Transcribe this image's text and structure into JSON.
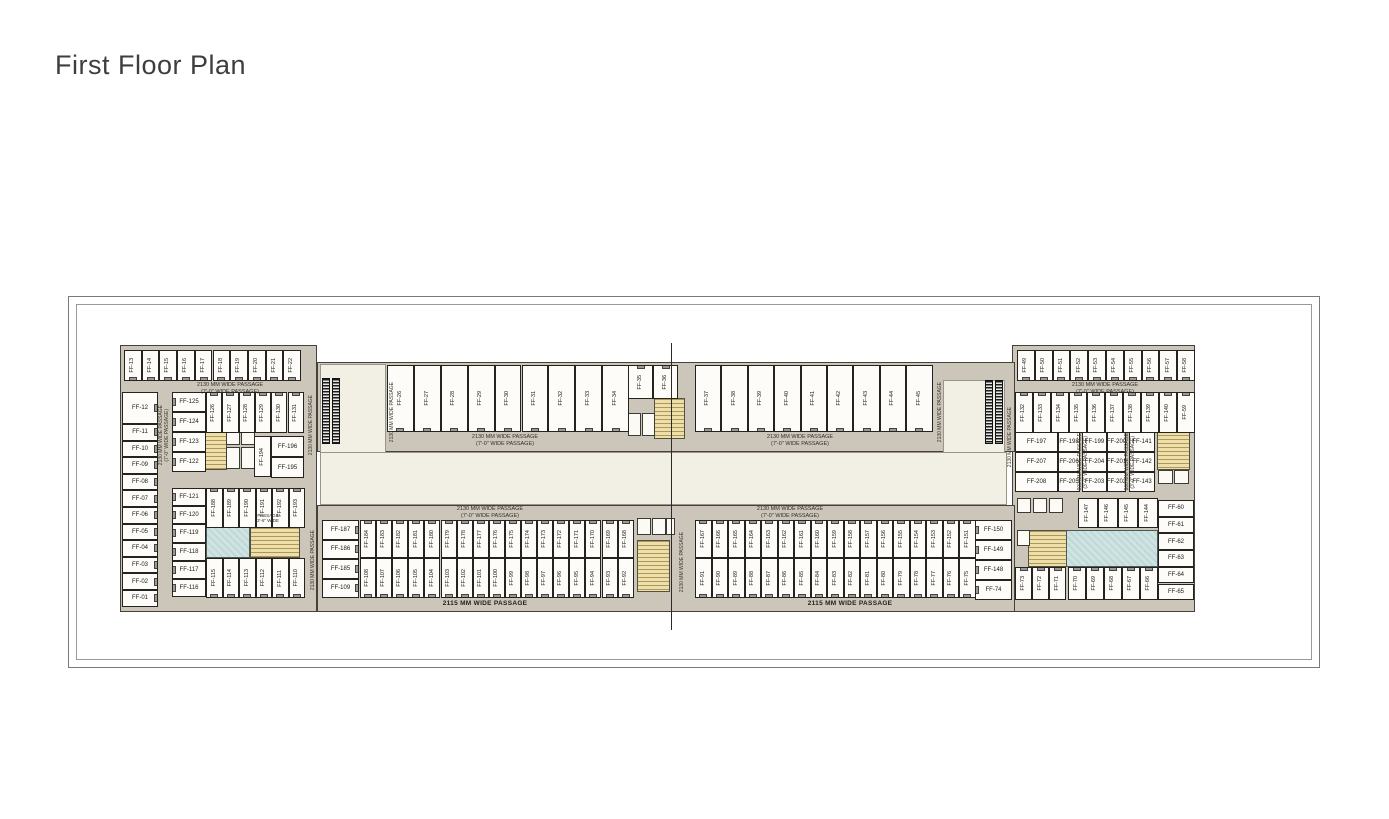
{
  "title": "First Floor Plan",
  "colors": {
    "plan_background": "#cbc5ba",
    "atrium": "#f2efe5",
    "unit_fill": "#fdfcf8",
    "wall": "#26231f",
    "stair": "#eedfa8",
    "toilet": "#cfe4e2",
    "escalator": "#1c1c1c"
  },
  "plan": {
    "base": [
      {
        "cls": "wing",
        "x": 120,
        "y": 345,
        "w": 197,
        "h": 267
      },
      {
        "cls": "wing",
        "x": 1012,
        "y": 345,
        "w": 183,
        "h": 267
      },
      {
        "cls": "band",
        "x": 317,
        "y": 362,
        "w": 698,
        "h": 90
      },
      {
        "cls": "band",
        "x": 317,
        "y": 505,
        "w": 698,
        "h": 107
      },
      {
        "cls": "atrium",
        "x": 320,
        "y": 364,
        "w": 66,
        "h": 141
      },
      {
        "cls": "atrium",
        "x": 943,
        "y": 380,
        "w": 62,
        "h": 125
      },
      {
        "cls": "atrium",
        "x": 320,
        "y": 452,
        "w": 687,
        "h": 53
      }
    ],
    "areas": [
      {
        "type": "stair",
        "x": 205,
        "y": 423,
        "w": 22,
        "h": 47
      },
      {
        "type": "stair",
        "x": 250,
        "y": 527,
        "w": 50,
        "h": 31
      },
      {
        "type": "stair",
        "x": 654,
        "y": 398,
        "w": 31,
        "h": 41
      },
      {
        "type": "stair",
        "x": 637,
        "y": 540,
        "w": 33,
        "h": 52
      },
      {
        "type": "stair",
        "x": 1157,
        "y": 426,
        "w": 33,
        "h": 44
      },
      {
        "type": "stair",
        "x": 1028,
        "y": 530,
        "w": 41,
        "h": 37
      },
      {
        "type": "toilet",
        "x": 206,
        "y": 527,
        "w": 44,
        "h": 31
      },
      {
        "type": "toilet",
        "x": 1066,
        "y": 530,
        "w": 92,
        "h": 37
      },
      {
        "type": "room",
        "x": 226,
        "y": 423,
        "w": 14,
        "h": 22
      },
      {
        "type": "room",
        "x": 241,
        "y": 423,
        "w": 14,
        "h": 22
      },
      {
        "type": "room",
        "x": 226,
        "y": 447,
        "w": 14,
        "h": 22
      },
      {
        "type": "room",
        "x": 241,
        "y": 447,
        "w": 14,
        "h": 22
      },
      {
        "type": "room",
        "x": 628,
        "y": 413,
        "w": 13,
        "h": 23
      },
      {
        "type": "room",
        "x": 642,
        "y": 413,
        "w": 13,
        "h": 23
      },
      {
        "type": "room",
        "x": 637,
        "y": 518,
        "w": 14,
        "h": 17
      },
      {
        "type": "room",
        "x": 652,
        "y": 518,
        "w": 14,
        "h": 17
      },
      {
        "type": "room",
        "x": 666,
        "y": 518,
        "w": 9,
        "h": 17
      },
      {
        "type": "room",
        "x": 1017,
        "y": 498,
        "w": 14,
        "h": 15
      },
      {
        "type": "room",
        "x": 1033,
        "y": 498,
        "w": 14,
        "h": 15
      },
      {
        "type": "room",
        "x": 1049,
        "y": 498,
        "w": 14,
        "h": 15
      },
      {
        "type": "room",
        "x": 1158,
        "y": 470,
        "w": 15,
        "h": 14
      },
      {
        "type": "room",
        "x": 1174,
        "y": 470,
        "w": 15,
        "h": 14
      },
      {
        "type": "room",
        "x": 1017,
        "y": 530,
        "w": 13,
        "h": 16
      },
      {
        "type": "esc",
        "x": 322,
        "y": 378,
        "w": 8,
        "h": 66
      },
      {
        "type": "esc",
        "x": 332,
        "y": 378,
        "w": 8,
        "h": 66
      },
      {
        "type": "esc",
        "x": 985,
        "y": 380,
        "w": 8,
        "h": 64
      },
      {
        "type": "esc",
        "x": 995,
        "y": 380,
        "w": 8,
        "h": 64
      }
    ],
    "groups": [
      {
        "name": "top-left-row",
        "o": "v",
        "door": "bottom",
        "x0": 124,
        "dx": 17.7,
        "y": 350,
        "h": 31,
        "labels": [
          "FF-13",
          "FF-14",
          "FF-15",
          "FF-16",
          "FF-17",
          "FF-18",
          "FF-19",
          "FF-20",
          "FF-21",
          "FF-22"
        ]
      },
      {
        "name": "left-ff12",
        "o": "h",
        "door": "right",
        "units": [
          {
            "label": "FF-12",
            "x": 122,
            "y": 392,
            "w": 36,
            "h": 32
          }
        ]
      },
      {
        "name": "left-col",
        "o": "h",
        "door": "right",
        "x": 122,
        "y0": 424,
        "dy": 16.6,
        "w": 36,
        "labels": [
          "FF-11",
          "FF-10",
          "FF-09",
          "FF-08",
          "FF-07",
          "FF-06",
          "FF-05",
          "FF-04",
          "FF-03",
          "FF-02",
          "FF-01"
        ]
      },
      {
        "name": "left-inner-col-upper",
        "o": "h",
        "door": "left",
        "x": 172,
        "y0": 392,
        "dy": 20,
        "w": 34,
        "labels": [
          "FF-125",
          "FF-124",
          "FF-123",
          "FF-122"
        ]
      },
      {
        "name": "left-inner-top-row",
        "o": "v",
        "door": "top",
        "x0": 206,
        "dx": 16.3,
        "y": 392,
        "h": 41,
        "labels": [
          "FF-126",
          "FF-127",
          "FF-128",
          "FF-129",
          "FF-130",
          "FF-131"
        ]
      },
      {
        "name": "ff-194",
        "o": "v",
        "units": [
          {
            "label": "FF-194",
            "x": 254,
            "y": 436,
            "w": 17,
            "h": 41
          }
        ]
      },
      {
        "name": "ff-196-195",
        "o": "h",
        "x": 271,
        "y0": 436,
        "dy": 21,
        "w": 33,
        "labels": [
          "FF-196",
          "FF-195"
        ]
      },
      {
        "name": "left-inner-col-lower",
        "o": "h",
        "door": "left",
        "x": 172,
        "y0": 488,
        "dy": 18.2,
        "w": 34,
        "labels": [
          "FF-121",
          "FF-120",
          "FF-119",
          "FF-118",
          "FF-117",
          "FF-116"
        ]
      },
      {
        "name": "left-inner-row-upper",
        "o": "v",
        "door": "top",
        "x0": 206,
        "dx": 16.5,
        "y": 488,
        "h": 40,
        "labels": [
          "FF-188",
          "FF-189",
          "FF-190",
          "FF-191",
          "FF-192",
          "FF-193"
        ]
      },
      {
        "name": "left-inner-row-lower",
        "o": "v",
        "door": "bottom",
        "x0": 206,
        "dx": 16.5,
        "y": 558,
        "h": 40,
        "labels": [
          "FF-115",
          "FF-114",
          "FF-113",
          "FF-112",
          "FF-111",
          "FF-110"
        ]
      },
      {
        "name": "top-row-26-34",
        "o": "v",
        "door": "bottom",
        "x0": 387,
        "dx": 26.9,
        "y": 365,
        "h": 67,
        "labels": [
          "FF-26",
          "FF-27",
          "FF-28",
          "FF-29",
          "FF-30",
          "FF-31",
          "FF-32",
          "FF-33",
          "FF-34"
        ]
      },
      {
        "name": "top-row-35-36",
        "o": "v",
        "door": "top",
        "x0": 628,
        "dx": 25,
        "y": 365,
        "h": 34,
        "labels": [
          "FF-35",
          "FF-36"
        ]
      },
      {
        "name": "top-row-37-45",
        "o": "v",
        "door": "bottom",
        "x0": 695,
        "dx": 26.4,
        "y": 365,
        "h": 67,
        "labels": [
          "FF-37",
          "FF-38",
          "FF-39",
          "FF-40",
          "FF-41",
          "FF-42",
          "FF-43",
          "FF-44",
          "FF-45"
        ]
      },
      {
        "name": "right-top-row",
        "o": "v",
        "door": "bottom",
        "x0": 1017,
        "dx": 17.8,
        "y": 350,
        "h": 31,
        "labels": [
          "FF-49",
          "FF-50",
          "FF-51",
          "FF-52",
          "FF-53",
          "FF-54",
          "FF-55",
          "FF-56",
          "FF-57",
          "FF-58"
        ]
      },
      {
        "name": "right-row-132",
        "o": "v",
        "door": "top",
        "x0": 1015,
        "dx": 18,
        "y": 392,
        "h": 41,
        "labels": [
          "FF-132",
          "FF-133",
          "FF-134",
          "FF-135",
          "FF-136",
          "FF-137",
          "FF-138",
          "FF-139",
          "FF-140",
          "FF-59"
        ]
      },
      {
        "name": "right-mid-units",
        "o": "h",
        "units": [
          {
            "label": "FF-197",
            "x": 1015,
            "y": 432,
            "w": 43,
            "h": 20
          },
          {
            "label": "FF-198",
            "x": 1058,
            "y": 432,
            "w": 22,
            "h": 20
          },
          {
            "label": "FF-199",
            "x": 1082,
            "y": 432,
            "w": 25,
            "h": 20
          },
          {
            "label": "FF-200",
            "x": 1107,
            "y": 432,
            "w": 19,
            "h": 20
          },
          {
            "label": "FF-141",
            "x": 1129,
            "y": 432,
            "w": 26,
            "h": 20
          },
          {
            "label": "FF-207",
            "x": 1015,
            "y": 452,
            "w": 43,
            "h": 20
          },
          {
            "label": "FF-206",
            "x": 1058,
            "y": 452,
            "w": 22,
            "h": 20
          },
          {
            "label": "FF-204",
            "x": 1082,
            "y": 452,
            "w": 25,
            "h": 20
          },
          {
            "label": "FF-201",
            "x": 1107,
            "y": 452,
            "w": 19,
            "h": 20
          },
          {
            "label": "FF-142",
            "x": 1129,
            "y": 452,
            "w": 26,
            "h": 20
          },
          {
            "label": "FF-208",
            "x": 1015,
            "y": 472,
            "w": 43,
            "h": 20
          },
          {
            "label": "FF-205",
            "x": 1058,
            "y": 472,
            "w": 22,
            "h": 20
          },
          {
            "label": "FF-203",
            "x": 1082,
            "y": 472,
            "w": 25,
            "h": 20
          },
          {
            "label": "FF-202",
            "x": 1107,
            "y": 472,
            "w": 19,
            "h": 20
          },
          {
            "label": "FF-143",
            "x": 1129,
            "y": 472,
            "w": 26,
            "h": 20
          }
        ]
      },
      {
        "name": "right-row-147",
        "o": "v",
        "x0": 1078,
        "dx": 20,
        "y": 498,
        "h": 30,
        "labels": [
          "FF-147",
          "FF-146",
          "FF-145",
          "FF-144"
        ]
      },
      {
        "name": "right-col-60",
        "o": "h",
        "x": 1158,
        "y0": 500,
        "dy": 16.7,
        "w": 36,
        "labels": [
          "FF-60",
          "FF-61",
          "FF-62",
          "FF-63",
          "FF-64",
          "FF-65"
        ]
      },
      {
        "name": "right-bottom-row-a",
        "o": "v",
        "door": "top",
        "x0": 1015,
        "dx": 17,
        "y": 567,
        "h": 33,
        "labels": [
          "FF-73",
          "FF-72",
          "FF-71"
        ]
      },
      {
        "name": "right-bottom-row-b",
        "o": "v",
        "door": "top",
        "x0": 1068,
        "dx": 18,
        "y": 567,
        "h": 33,
        "labels": [
          "FF-70",
          "FF-69",
          "FF-68",
          "FF-67",
          "FF-66"
        ]
      },
      {
        "name": "bottom-left-col",
        "o": "h",
        "door": "right",
        "x": 322,
        "y0": 520,
        "dy": 19.5,
        "w": 37,
        "labels": [
          "FF-187",
          "FF-186",
          "FF-185",
          "FF-109"
        ]
      },
      {
        "name": "bottom-left-top-row",
        "o": "v",
        "door": "top",
        "x0": 360,
        "dx": 16.1,
        "y": 520,
        "h": 38,
        "labels": [
          "FF-184",
          "FF-183",
          "FF-182",
          "FF-181",
          "FF-180",
          "FF-179",
          "FF-178",
          "FF-177",
          "FF-176",
          "FF-175",
          "FF-174",
          "FF-173",
          "FF-172",
          "FF-171",
          "FF-170",
          "FF-169",
          "FF-168"
        ]
      },
      {
        "name": "bottom-left-bottom-row",
        "o": "v",
        "door": "bottom",
        "x0": 360,
        "dx": 16.1,
        "y": 558,
        "h": 40,
        "labels": [
          "FF-108",
          "FF-107",
          "FF-106",
          "FF-105",
          "FF-104",
          "FF-103",
          "FF-102",
          "FF-101",
          "FF-100",
          "FF-99",
          "FF-98",
          "FF-97",
          "FF-96",
          "FF-95",
          "FF-94",
          "FF-93",
          "FF-92"
        ]
      },
      {
        "name": "bottom-right-top-row",
        "o": "v",
        "door": "top",
        "x0": 695,
        "dx": 16.5,
        "y": 520,
        "h": 38,
        "labels": [
          "FF-167",
          "FF-166",
          "FF-165",
          "FF-164",
          "FF-163",
          "FF-162",
          "FF-161",
          "FF-160",
          "FF-159",
          "FF-158",
          "FF-157",
          "FF-156",
          "FF-155",
          "FF-154",
          "FF-153",
          "FF-152",
          "FF-151"
        ]
      },
      {
        "name": "bottom-right-bottom-row",
        "o": "v",
        "door": "bottom",
        "x0": 695,
        "dx": 16.5,
        "y": 558,
        "h": 40,
        "labels": [
          "FF-91",
          "FF-90",
          "FF-89",
          "FF-88",
          "FF-87",
          "FF-86",
          "FF-85",
          "FF-84",
          "FF-83",
          "FF-82",
          "FF-81",
          "FF-80",
          "FF-79",
          "FF-78",
          "FF-77",
          "FF-76",
          "FF-75"
        ]
      },
      {
        "name": "bottom-right-col",
        "o": "h",
        "door": "left",
        "x": 975,
        "y0": 520,
        "dy": 20,
        "w": 37,
        "labels": [
          "FF-150",
          "FF-149",
          "FF-148",
          "FF-74"
        ]
      }
    ],
    "passages_h": [
      {
        "x": 230,
        "y": 382,
        "lines": [
          "2130 MM WIDE PASSAGE",
          "(7'-0\" WIDE PASSAGE)"
        ]
      },
      {
        "x": 505,
        "y": 434,
        "lines": [
          "2130 MM WIDE PASSAGE",
          "(7'-0\" WIDE PASSAGE)"
        ]
      },
      {
        "x": 800,
        "y": 434,
        "lines": [
          "2130 MM WIDE PASSAGE",
          "(7'-0\" WIDE PASSAGE)"
        ]
      },
      {
        "x": 1105,
        "y": 382,
        "lines": [
          "2130 MM WIDE PASSAGE",
          "(7'-0\" WIDE PASSAGE)"
        ]
      },
      {
        "x": 490,
        "y": 506,
        "lines": [
          "2130 MM WIDE PASSAGE",
          "(7'-0\" WIDE PASSAGE)"
        ]
      },
      {
        "x": 790,
        "y": 506,
        "lines": [
          "2130 MM WIDE PASSAGE",
          "(7'-0\" WIDE PASSAGE)"
        ]
      },
      {
        "x": 485,
        "y": 600,
        "bold": true,
        "lines": [
          "2115 MM WIDE PASSAGE"
        ]
      },
      {
        "x": 850,
        "y": 600,
        "bold": true,
        "lines": [
          "2115 MM WIDE PASSAGE"
        ]
      }
    ],
    "passages_v": [
      {
        "x": 157,
        "y": 392,
        "h": 86,
        "lines": [
          "2130 MM WIDE PASSAGE",
          "(7'-0\" WIDE PASSAGE)"
        ]
      },
      {
        "x": 304,
        "y": 380,
        "h": 90,
        "lines": [
          "2130 MM WIDE PASSAGE"
        ]
      },
      {
        "x": 385,
        "y": 375,
        "h": 75,
        "lines": [
          "2130 MM WIDE PASSAGE"
        ]
      },
      {
        "x": 933,
        "y": 375,
        "h": 75,
        "lines": [
          "2130 MM WIDE PASSAGE"
        ]
      },
      {
        "x": 1003,
        "y": 395,
        "h": 85,
        "lines": [
          "2130 MM WIDE PASSAGE"
        ]
      },
      {
        "x": 306,
        "y": 520,
        "h": 80,
        "lines": [
          "2130 MM WIDE PASSAGE"
        ]
      },
      {
        "x": 675,
        "y": 528,
        "h": 68,
        "lines": [
          "2130 MM WIDE PASSAGE"
        ]
      },
      {
        "x": 1076,
        "y": 432,
        "h": 60,
        "lines": [
          "900 MM WIDE PASSAGE",
          "(3'-0\" WIDE PASSAGE)"
        ]
      },
      {
        "x": 1123,
        "y": 432,
        "h": 60,
        "lines": [
          "900 MM WIDE PASSAGE",
          "(3'-0\" WIDE PASSAGE)"
        ]
      }
    ],
    "tiny_labels": [
      {
        "x": 268,
        "y": 513,
        "lines": [
          "PASSAGE",
          "3'-6\" WIDE"
        ]
      }
    ],
    "section_line": {
      "x": 671,
      "y": 343,
      "h": 287
    }
  }
}
